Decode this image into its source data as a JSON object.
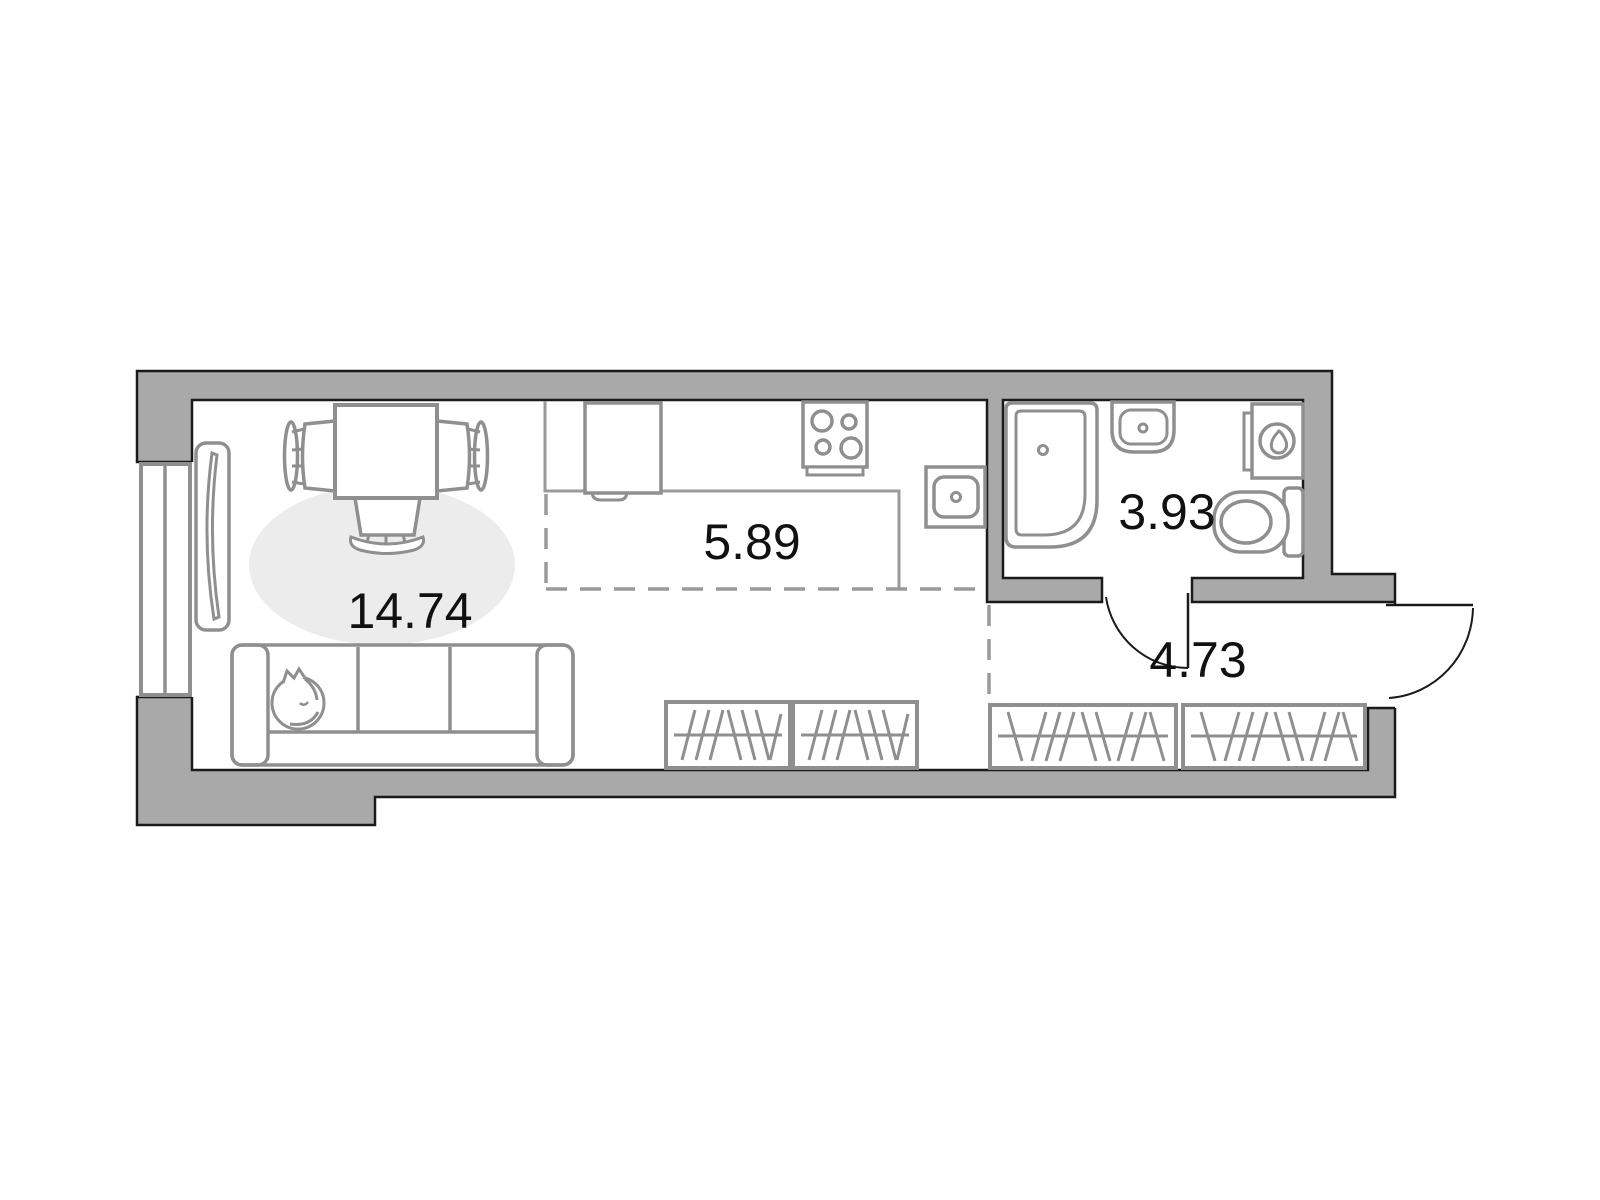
{
  "plan": {
    "type": "studio-apartment-floor-plan",
    "canvas": {
      "width": 1600,
      "height": 1200
    },
    "colors": {
      "background": "#ffffff",
      "wall_fill": "#a9a9a9",
      "wall_outline": "#1a1a1a",
      "furniture_stroke": "#8f8f8f",
      "zone_line": "#9a9a9a",
      "highlight_fill": "#ececec",
      "label_color": "#111111"
    },
    "rooms": [
      {
        "id": "living-room",
        "area": "14.74"
      },
      {
        "id": "kitchen-zone",
        "area": "5.89"
      },
      {
        "id": "bathroom",
        "area": "3.93"
      },
      {
        "id": "hallway",
        "area": "4.73"
      }
    ],
    "furniture": [
      "window",
      "radiator-panel",
      "dining-table",
      "chair-left",
      "chair-right",
      "chair-bottom",
      "sofa",
      "sleeping-cat",
      "fridge",
      "stove-4-burners",
      "kitchen-sink",
      "counter",
      "bathtub",
      "wash-basin",
      "washing-machine",
      "toilet",
      "wardrobe-1",
      "wardrobe-2",
      "wardrobe-3",
      "wardrobe-4",
      "bathroom-door-swing",
      "entry-door-swing"
    ]
  }
}
